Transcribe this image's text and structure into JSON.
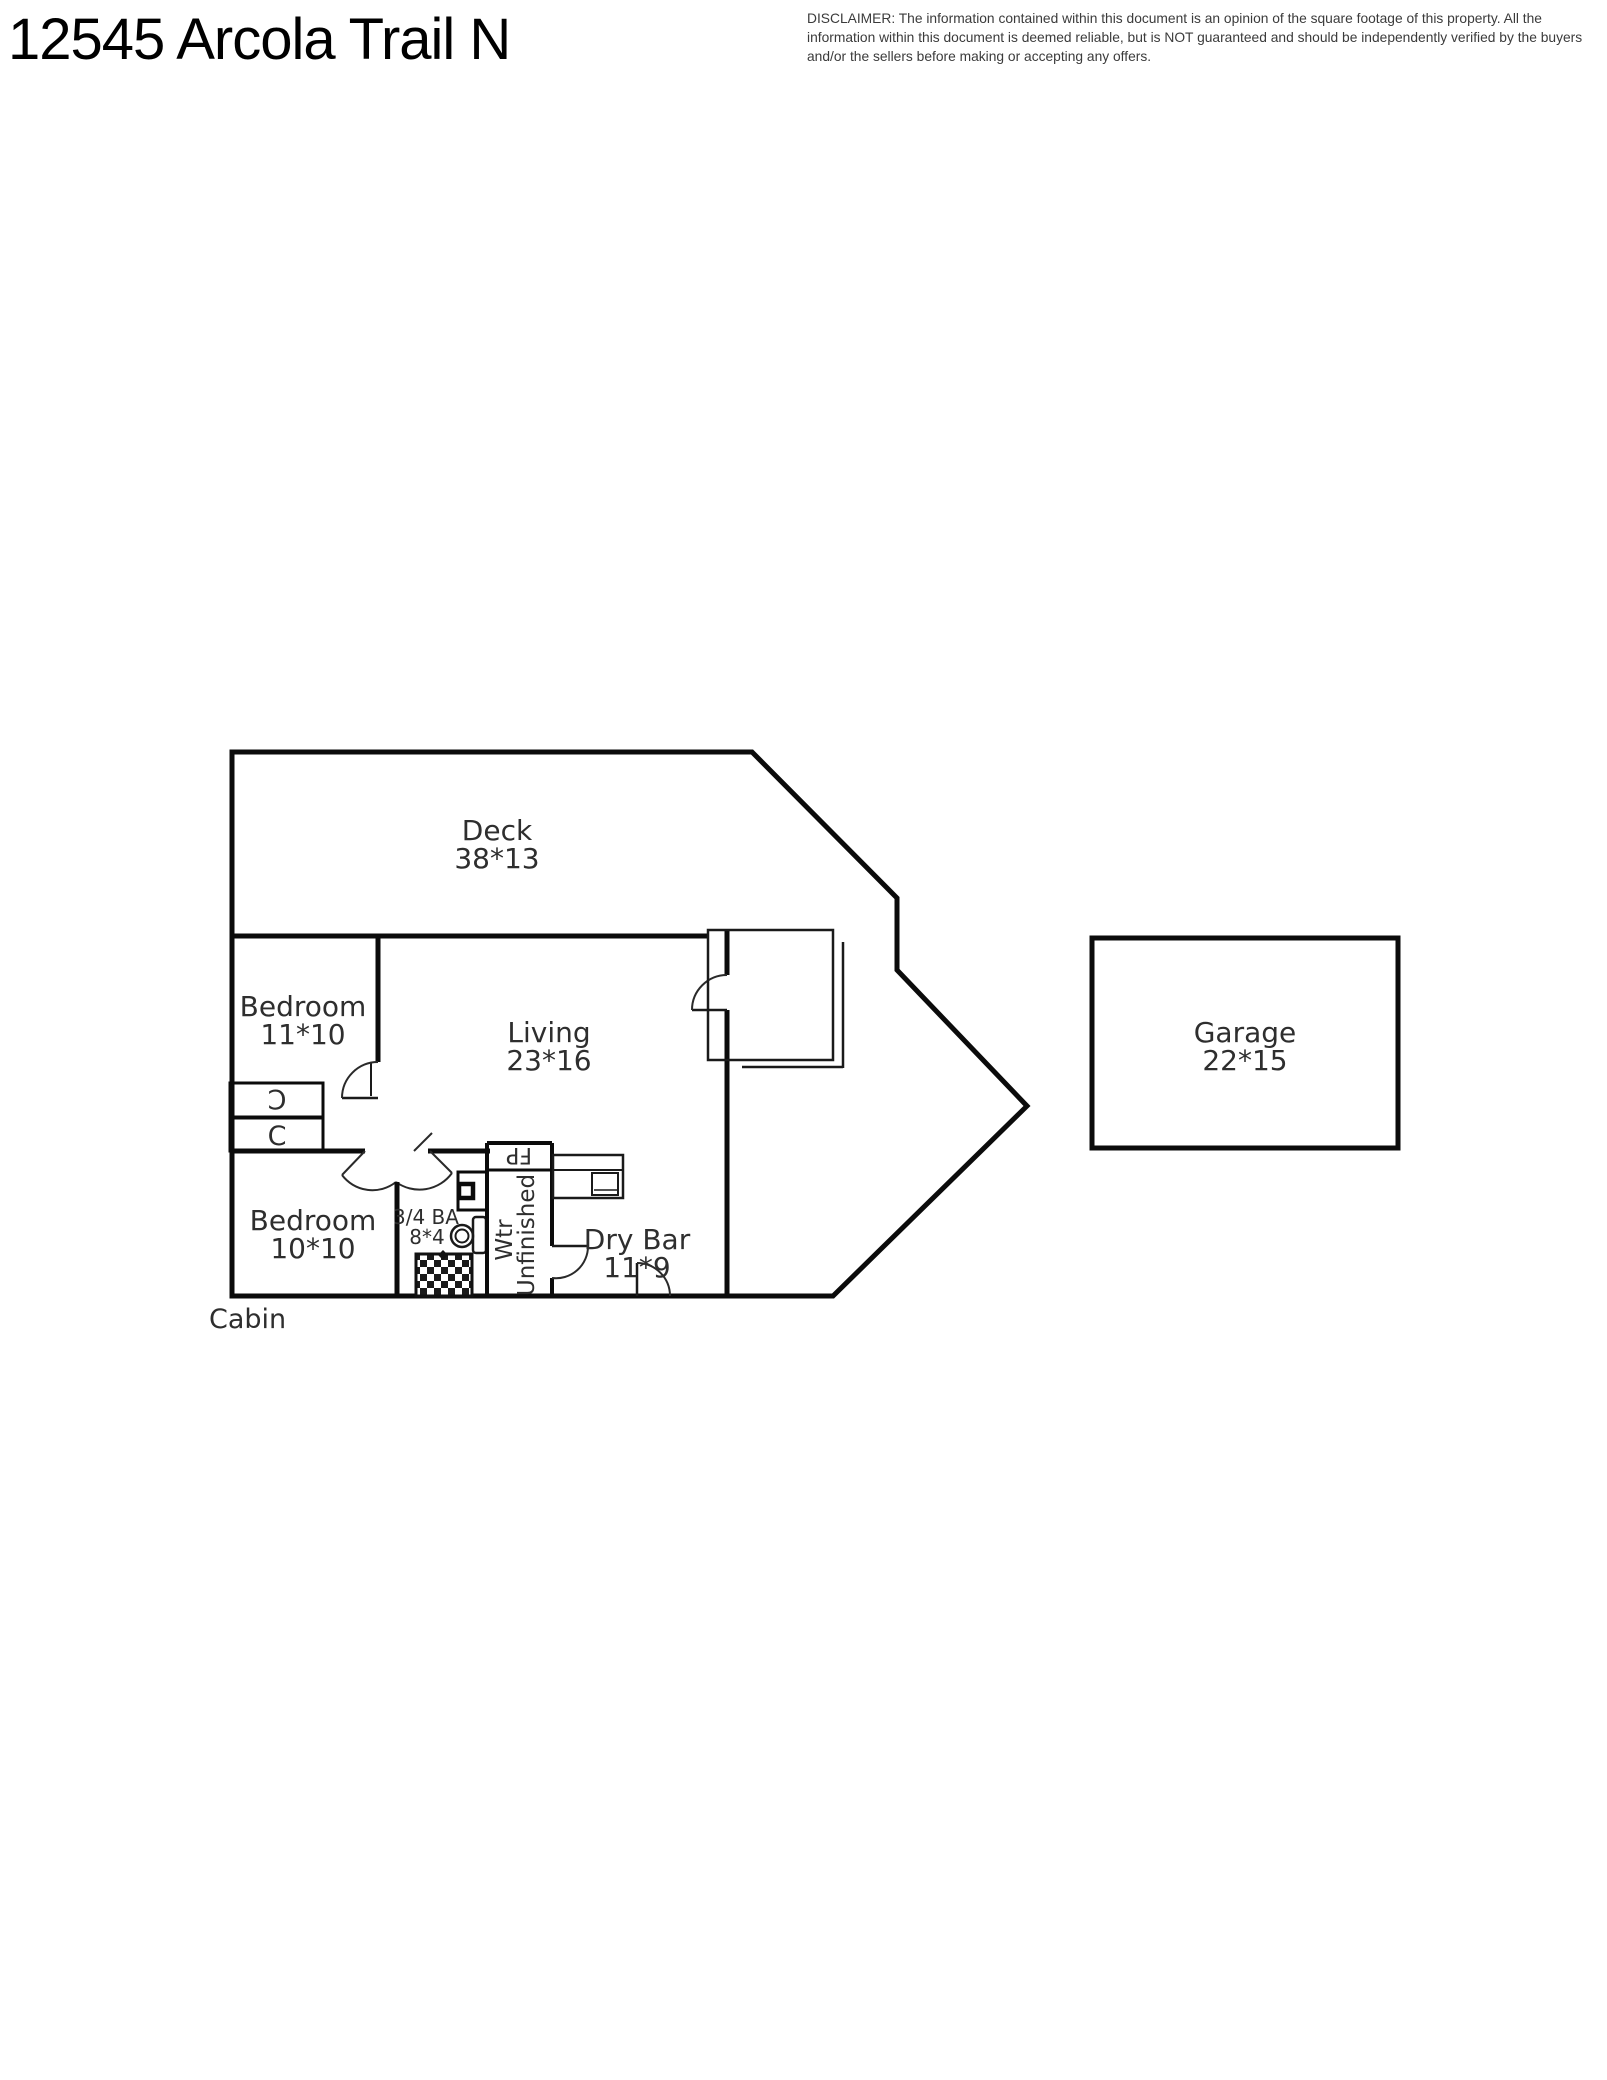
{
  "header": {
    "title": "12545 Arcola Trail N",
    "disclaimer": "DISCLAIMER: The information contained within this document is an opinion of the square footage of this property. All the information within this document is deemed reliable, but is NOT guaranteed and should be independently verified by the buyers and/or the sellers before making or accepting any offers."
  },
  "plan": {
    "building_label": "Cabin",
    "rooms": {
      "deck": {
        "name": "Deck",
        "dims": "38*13"
      },
      "bedroom_upper": {
        "name": "Bedroom",
        "dims": "11*10"
      },
      "living": {
        "name": "Living",
        "dims": "23*16"
      },
      "bedroom_lower": {
        "name": "Bedroom",
        "dims": "10*10"
      },
      "bath": {
        "name": "3/4 BA",
        "dims": "8*4"
      },
      "water_unfinished": {
        "line1": "Wtr",
        "line2": "Unfinished"
      },
      "dry_bar": {
        "name": "Dry Bar",
        "dims": "11*9"
      },
      "garage": {
        "name": "Garage",
        "dims": "22*15"
      }
    },
    "fixtures": {
      "fireplace": "FP",
      "closet_top": "C",
      "closet_bottom": "C"
    },
    "line_color": "#0b0b0b",
    "label_color": "#2e2e2e"
  }
}
